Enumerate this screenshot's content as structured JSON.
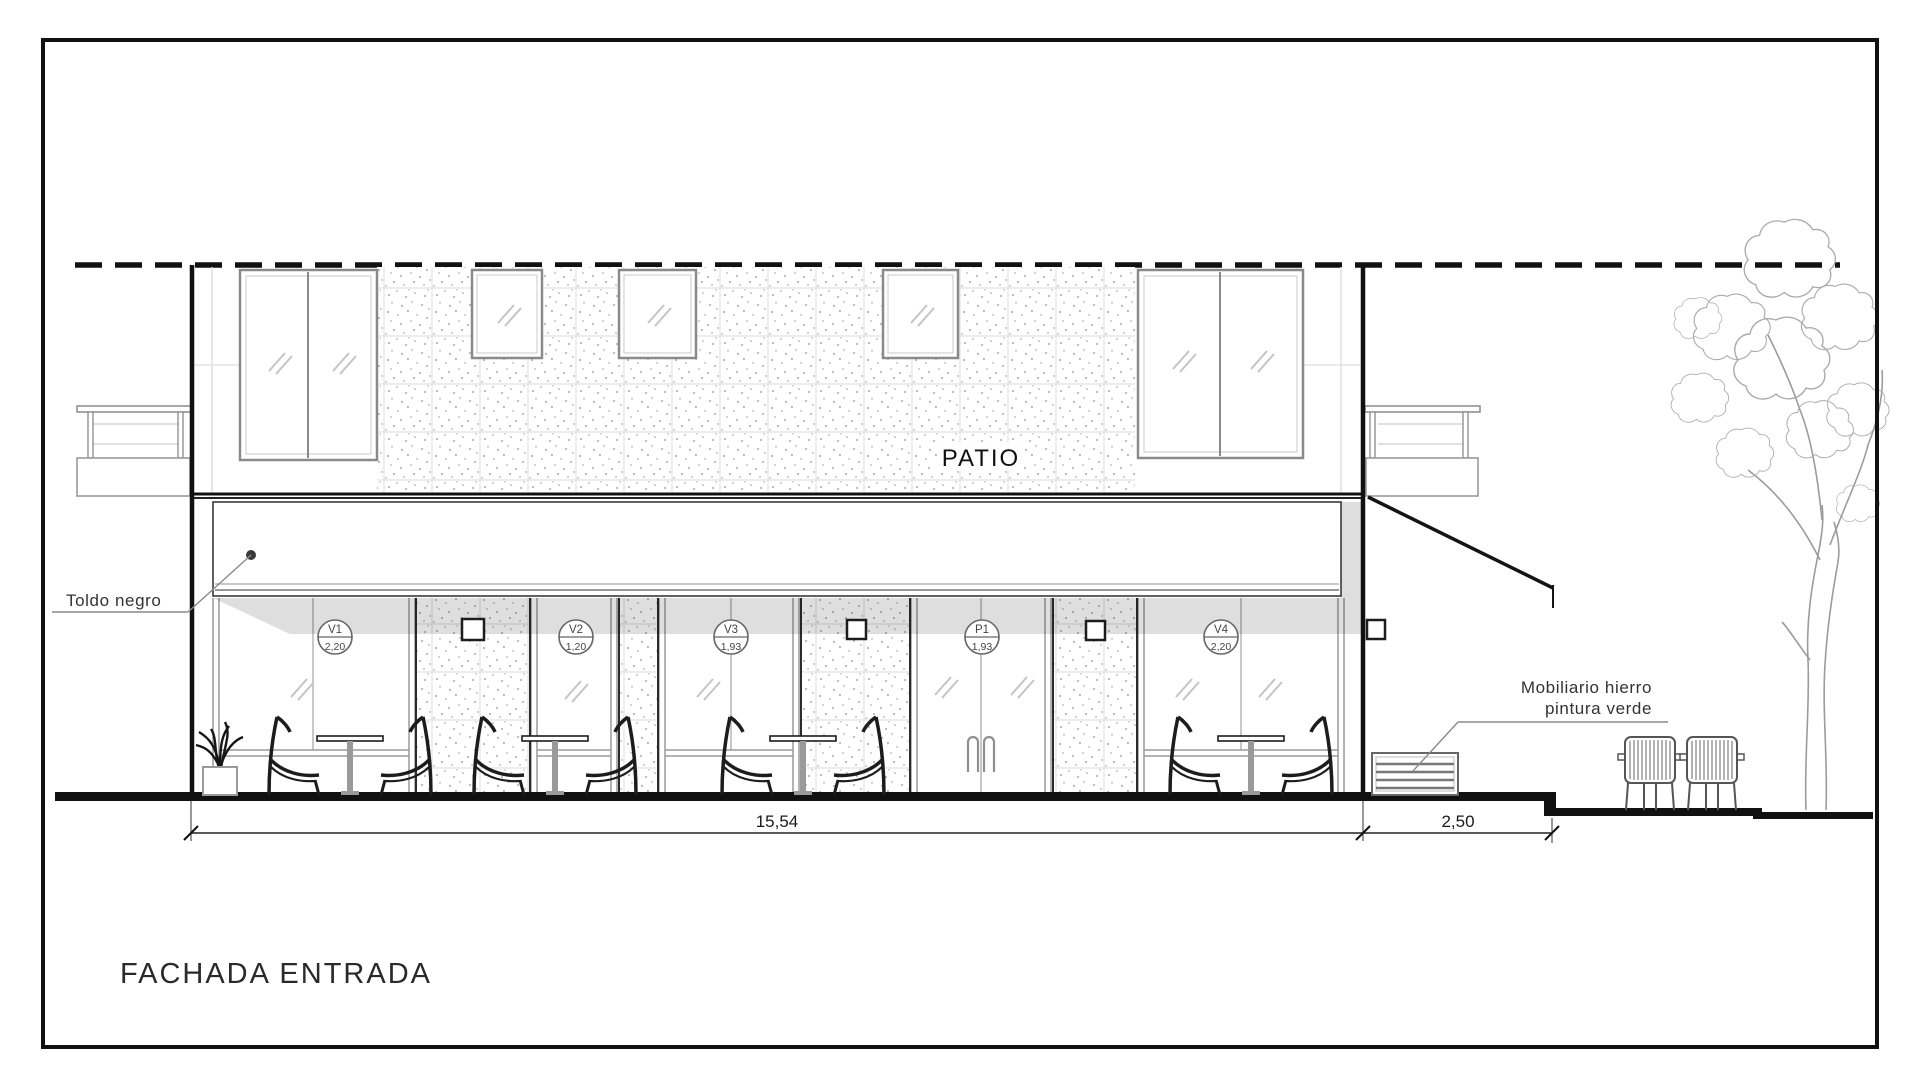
{
  "title": "FACHADA ENTRADA",
  "labels": {
    "patio": "PATIO",
    "awning": "Toldo negro",
    "furniture_line1": "Mobiliario hierro",
    "furniture_line2": "pintura verde"
  },
  "window_tags": [
    {
      "id": "V1",
      "size": "2,20"
    },
    {
      "id": "V2",
      "size": "1,20"
    },
    {
      "id": "V3",
      "size": "1,93"
    },
    {
      "id": "P1",
      "size": "1,93"
    },
    {
      "id": "V4",
      "size": "2,20"
    }
  ],
  "dimensions": {
    "facade_width": "15,54",
    "terrace_width": "2,50"
  },
  "colors": {
    "ink": "#1a1a1a",
    "line_gray": "#9a9a9a",
    "light_gray": "#d9d9d9",
    "paper": "#ffffff"
  }
}
